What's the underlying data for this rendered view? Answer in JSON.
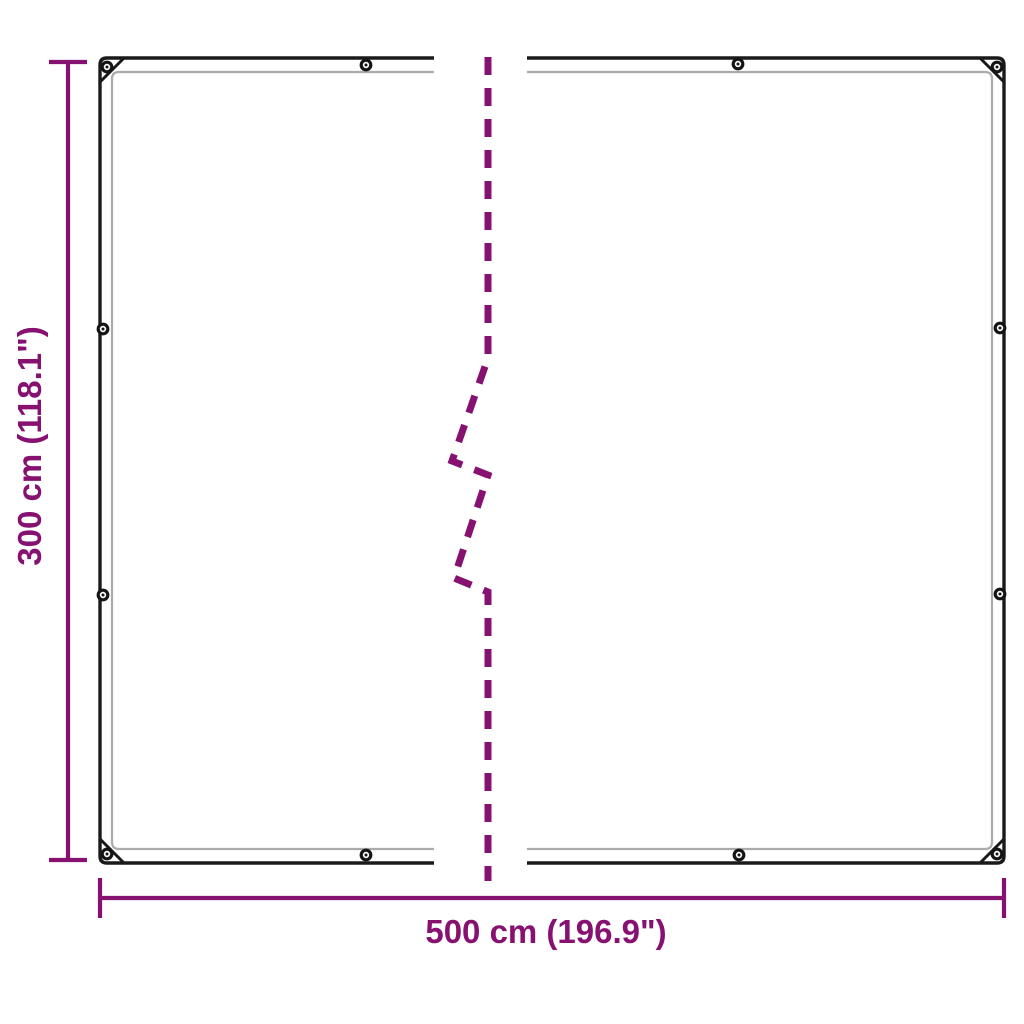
{
  "diagram": {
    "height_label": "300 cm (118.1\")",
    "width_label": "500 cm (196.9\")",
    "dimensions": {
      "width_cm": 500,
      "height_cm": 300,
      "width_inches": 196.9,
      "height_inches": 118.1
    },
    "colors": {
      "dimension": "#871170",
      "outline": "#1a1a1a",
      "hem": "#ababab",
      "background": "#ffffff"
    },
    "grommet_count": 12,
    "icons": {
      "grommet": "grommet-ring-icon",
      "break": "dashed-break-line"
    }
  }
}
